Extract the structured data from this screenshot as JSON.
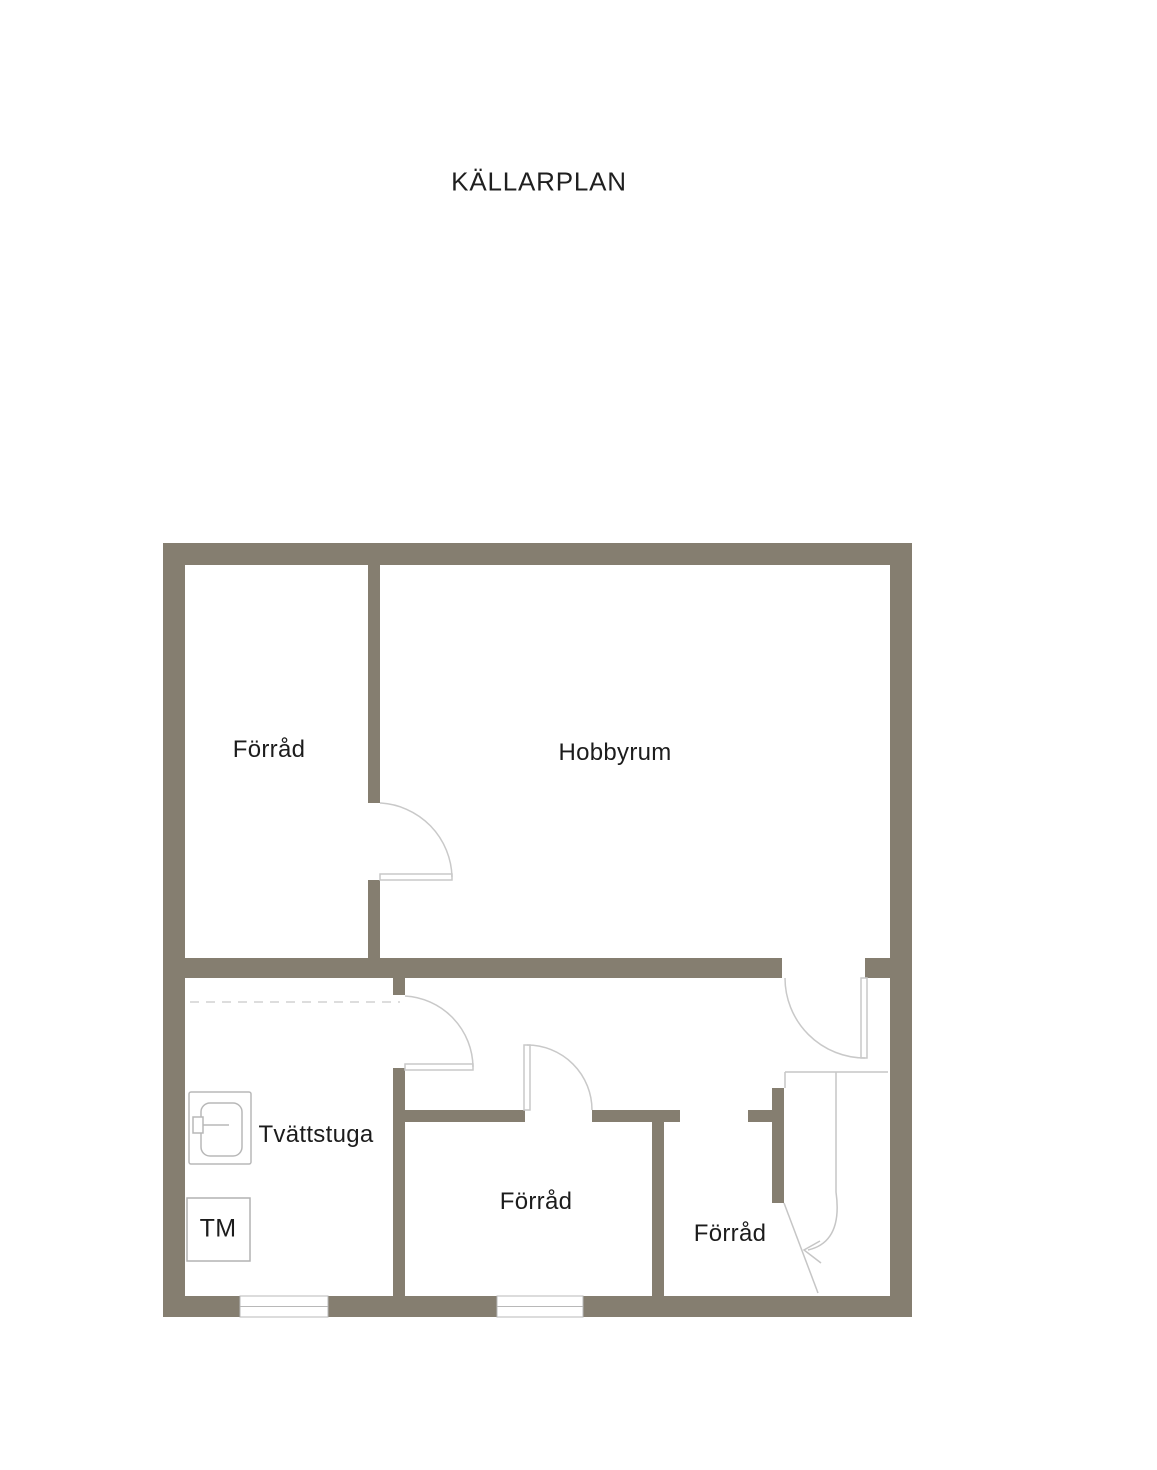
{
  "page": {
    "title": "KÄLLARPLAN"
  },
  "floorplan": {
    "rooms": [
      {
        "id": "storage-top-left",
        "label": "Förråd"
      },
      {
        "id": "hobby-room",
        "label": "Hobbyrum"
      },
      {
        "id": "laundry-room",
        "label": "Tvättstuga"
      },
      {
        "id": "storage-bottom-middle",
        "label": "Förråd"
      },
      {
        "id": "storage-bottom-right",
        "label": "Förråd"
      }
    ],
    "fixtures": [
      {
        "id": "washing-machine",
        "label": "TM"
      },
      {
        "id": "laundry-sink-icon"
      },
      {
        "id": "staircase-down-arrow"
      }
    ],
    "features": {
      "doors": 4,
      "windows": 2,
      "dashed_ceiling_marker": true
    },
    "colors": {
      "wall": "#857e70",
      "door_swing_line": "#c9c9c9",
      "fixture_line": "#b4b4b4",
      "label_text": "#1c1c1c",
      "background": "#ffffff"
    }
  }
}
